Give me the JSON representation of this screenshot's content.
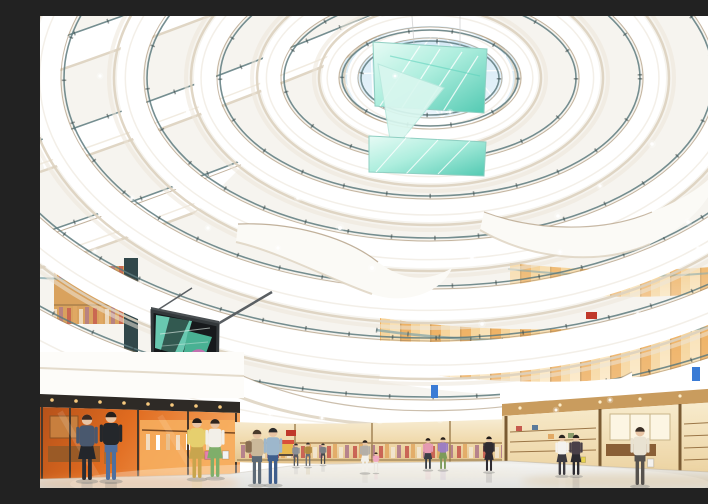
{
  "scene": {
    "type": "architectural-rendering",
    "description": "Rendering of a multi-level shopping mall atrium: sweeping white curved balconies spiral upward to a triangulated glass skylight, aqua LED art panels hang in the void, a large video wall shows a fashion clip, warmly lit storefronts line the levels, an orange shop anchors the lower left, and shoppers cross the polished ground floor.",
    "people_count": 19
  },
  "palette": {
    "bg": "#f6f4ef",
    "white": "#ffffff",
    "cream": "#ddd2bf",
    "cream2": "#ece5d8",
    "railTeal": "#5d7a7e",
    "railDark": "#2f3e3e",
    "bronze": "#9a7f5c",
    "sky1": "#cfe6f4",
    "sky2": "#eef7fc",
    "aqua1": "#aeeede",
    "aqua2": "#52c9b2",
    "aquaLight": "#e7fbf5",
    "warm1": "#e8a159",
    "warm2": "#f6d9a8",
    "orange1": "#e06b1f",
    "orange2": "#f5a35c",
    "wood": "#8a5f36",
    "screenDark": "#17191c",
    "magenta": "#cf6ab5",
    "floor1": "#f1f0ed",
    "floor2": "#d5d6d3",
    "signBlue": "#3a7bd5",
    "signRed": "#c0392b",
    "soffitLight": "#f7c97e"
  },
  "led_screen": {
    "frame": "#33383b",
    "background": "#17191c",
    "accent_teal": "#6ed2b8",
    "accent_magenta": "#cf6ab5"
  },
  "people": [
    {
      "x": 47,
      "y": 464,
      "h": 70,
      "hair": "#3a2a22",
      "top": "#49586e",
      "bottom": "#23262b",
      "legs": "#2a2d33",
      "skirt": true
    },
    {
      "x": 71,
      "y": 464,
      "h": 73,
      "hair": "#261e19",
      "top": "#24272b",
      "bottom": "#4f6f9e",
      "legs": "#4f6f9e"
    },
    {
      "x": 157,
      "y": 462,
      "h": 64,
      "hair": "#241c18",
      "top": "#e6cf6e",
      "bottom": "#c8a54e",
      "skirt": true,
      "bag": "#e87fae"
    },
    {
      "x": 175,
      "y": 461,
      "h": 62,
      "hair": "#2e241e",
      "top": "#f2efe8",
      "bottom": "#7fae6a",
      "skirt": true,
      "bag": "#f2f2f2"
    },
    {
      "x": 217,
      "y": 468,
      "h": 58,
      "hair": "#4a3a2c",
      "top": "#cbb89a",
      "bottom": "#5e6a76",
      "pack": "#8a6f52"
    },
    {
      "x": 233,
      "y": 468,
      "h": 60,
      "hair": "#2c2c2c",
      "top": "#9db7cc",
      "bottom": "#3f5e8c"
    },
    {
      "x": 256,
      "y": 450,
      "h": 24,
      "hair": "#33302c",
      "top": "#8a8f96",
      "bottom": "#55595f"
    },
    {
      "x": 268,
      "y": 450,
      "h": 25,
      "hair": "#33302c",
      "top": "#b0893f",
      "bottom": "#6a6f75"
    },
    {
      "x": 283,
      "y": 448,
      "h": 22,
      "hair": "#33302c",
      "top": "#7a7e83",
      "bottom": "#46494e"
    },
    {
      "x": 325,
      "y": 456,
      "h": 34,
      "hair": "#26201c",
      "top": "#b4afa8",
      "bottom": "#f2f0ea",
      "skirt": true
    },
    {
      "x": 336,
      "y": 456,
      "h": 21,
      "hair": "#3a2d24",
      "top": "#f0a8c0",
      "bottom": "#eae6e0"
    },
    {
      "x": 388,
      "y": 453,
      "h": 33,
      "hair": "#241e1a",
      "top": "#e59ab2",
      "bottom": "#3a3f46",
      "skirt": true
    },
    {
      "x": 403,
      "y": 453,
      "h": 34,
      "hair": "#241e1a",
      "top": "#9d7ec2",
      "bottom": "#7d9a5a",
      "skirt": true
    },
    {
      "x": 449,
      "y": 455,
      "h": 37,
      "hair": "#1e1a18",
      "top": "#2f2b31",
      "bottom": "#2f2b31",
      "skirt": true
    },
    {
      "x": 522,
      "y": 459,
      "h": 43,
      "hair": "#2a2420",
      "top": "#f4f2ee",
      "bottom": "#3c3a40",
      "skirt": true
    },
    {
      "x": 536,
      "y": 459,
      "h": 43,
      "hair": "#2a2420",
      "top": "#4a4048",
      "bottom": "#2c2a30",
      "skirt": true,
      "bag": "#e8d44e"
    },
    {
      "x": 600,
      "y": 469,
      "h": 62,
      "hair": "#3a2e26",
      "top": "#e9e2d2",
      "bottom": "#56524e",
      "bag": "#f4f2ee"
    },
    {
      "x": 680,
      "y": 456,
      "h": 32,
      "hair": "#25231f",
      "top": "#3a3f3a",
      "bottom": "#2e3236"
    },
    {
      "x": 692,
      "y": 456,
      "h": 33,
      "hair": "#25231f",
      "top": "#6a6458",
      "bottom": "#3a3e42"
    }
  ],
  "sparkles": [
    [
      148,
      96,
      2
    ],
    [
      210,
      142,
      1.8
    ],
    [
      258,
      182,
      1.8
    ],
    [
      300,
      212,
      2
    ],
    [
      238,
      232,
      1.6
    ],
    [
      168,
      212,
      1.6
    ],
    [
      332,
      252,
      2
    ],
    [
      432,
      242,
      1.8
    ],
    [
      518,
      200,
      1.8
    ],
    [
      560,
      170,
      1.6
    ],
    [
      478,
      150,
      1.6
    ],
    [
      612,
      128,
      1.8
    ],
    [
      648,
      206,
      1.8
    ],
    [
      92,
      182,
      1.6
    ],
    [
      55,
      235,
      1.6
    ],
    [
      100,
      268,
      1.6
    ],
    [
      372,
      300,
      1.8
    ],
    [
      442,
      308,
      1.8
    ],
    [
      205,
      322,
      1.6
    ],
    [
      282,
      332,
      1.6
    ],
    [
      598,
      298,
      1.8
    ],
    [
      658,
      232,
      1.6
    ],
    [
      520,
      236,
      1.6
    ],
    [
      60,
      60,
      1.6
    ],
    [
      160,
      40,
      1.6
    ],
    [
      695,
      180,
      1.8
    ],
    [
      230,
      398,
      1.5
    ],
    [
      282,
      402,
      1.5
    ],
    [
      340,
      405,
      1.5
    ],
    [
      400,
      404,
      1.5
    ],
    [
      458,
      400,
      1.5
    ],
    [
      516,
      394,
      1.5
    ],
    [
      570,
      384,
      1.5
    ],
    [
      368,
      120,
      1.5
    ],
    [
      410,
      96,
      1.5
    ],
    [
      355,
      60,
      1.4
    ]
  ],
  "rings": [
    [
      78,
      46,
      10
    ],
    [
      100,
      60,
      16
    ],
    [
      160,
      95,
      20
    ],
    [
      225,
      133,
      22
    ],
    [
      300,
      177,
      26
    ],
    [
      385,
      227,
      30
    ],
    [
      478,
      281,
      34
    ],
    [
      582,
      343,
      40
    ],
    [
      690,
      413,
      46
    ]
  ]
}
